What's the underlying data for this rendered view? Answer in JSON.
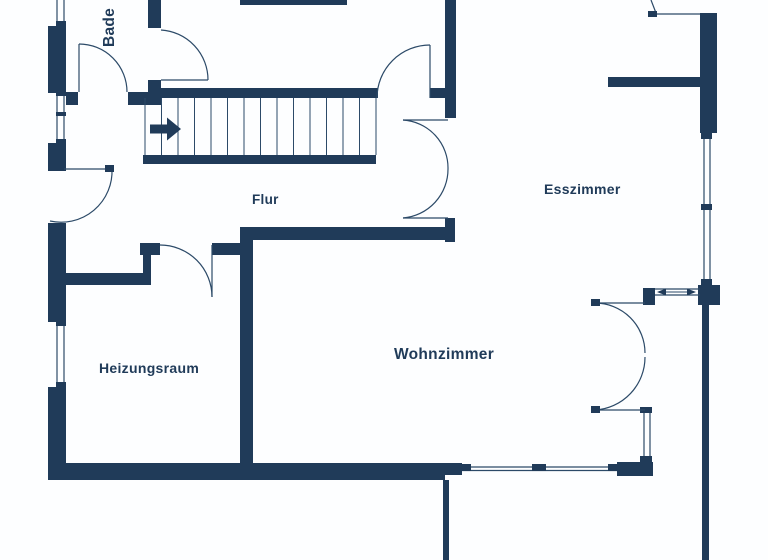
{
  "floorplan": {
    "type": "architectural-floor-plan",
    "rooms": [
      {
        "id": "badezimmer",
        "label": "Bade"
      },
      {
        "id": "flur",
        "label": "Flur"
      },
      {
        "id": "esszimmer",
        "label": "Esszimmer"
      },
      {
        "id": "wohnzimmer",
        "label": "Wohnzimmer"
      },
      {
        "id": "heizungsraum",
        "label": "Heizungsraum"
      }
    ],
    "stairs": {
      "direction_arrow": "right",
      "tread_count": 15
    },
    "colors": {
      "wall": "#203b59",
      "line": "#2c4a68",
      "text": "#203b59",
      "background": "#fdfeff"
    }
  }
}
